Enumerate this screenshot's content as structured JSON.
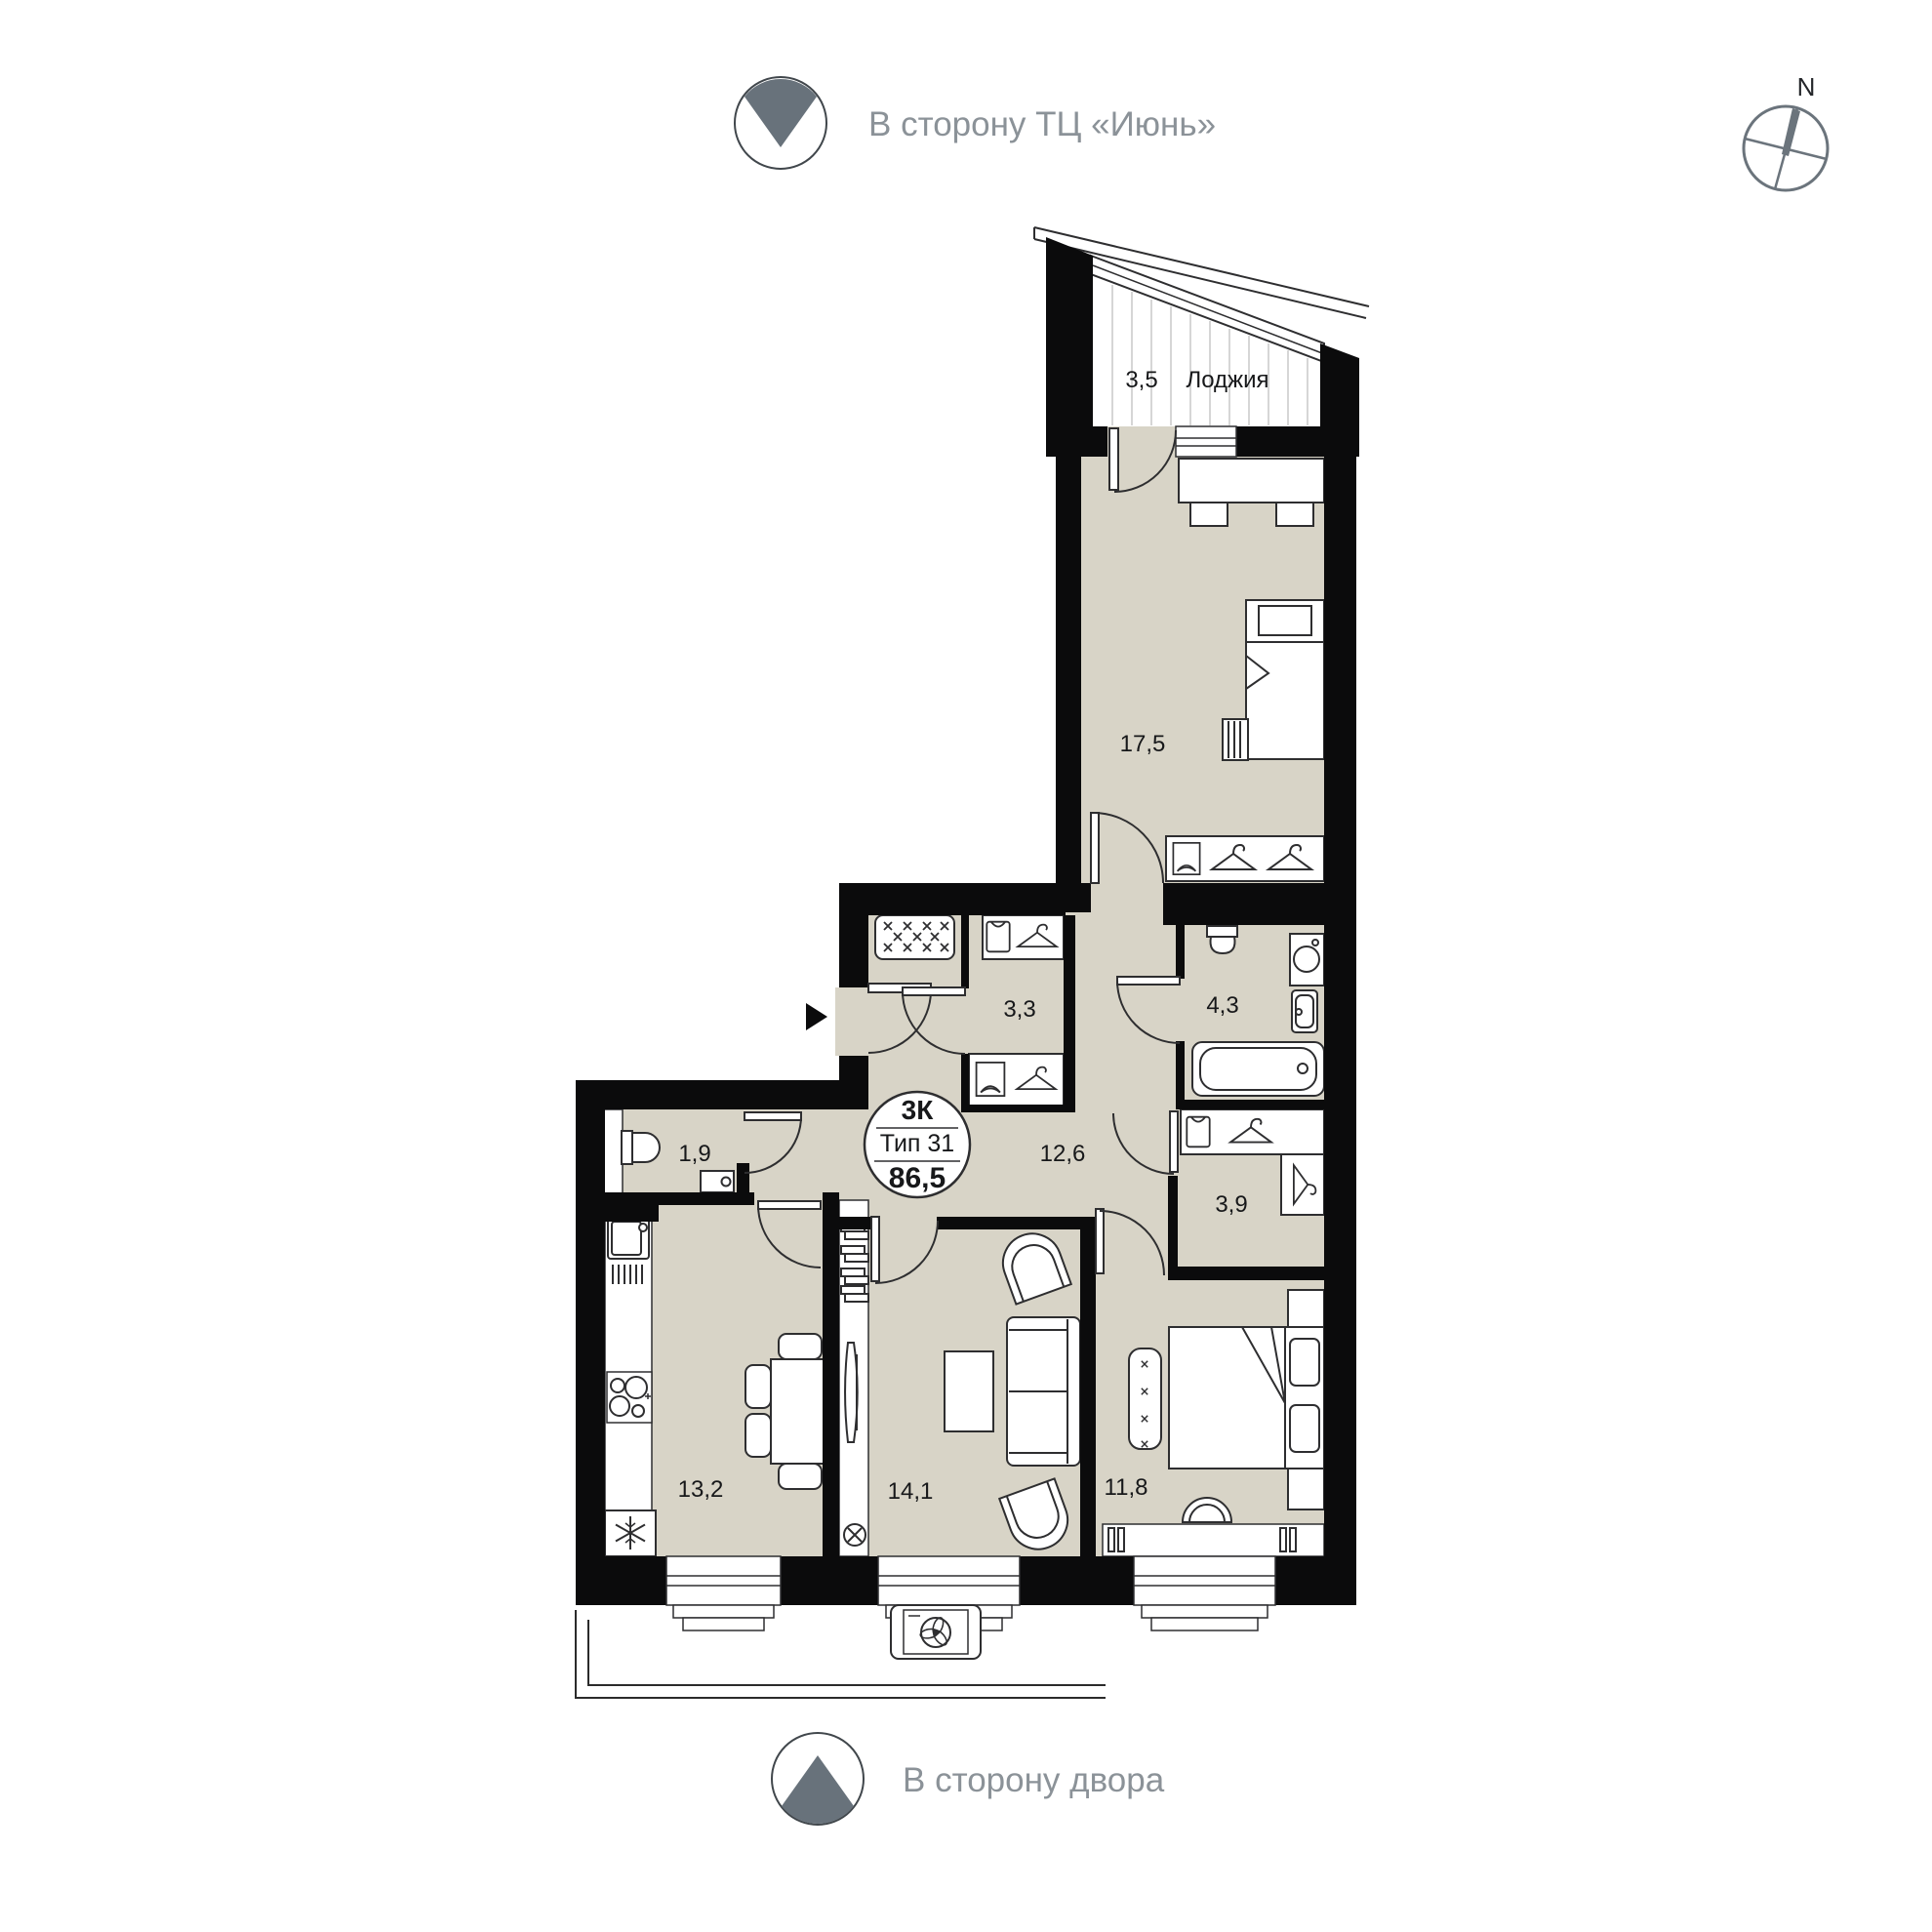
{
  "direction_top": {
    "label": "В сторону ТЦ «Июнь»"
  },
  "direction_bottom": {
    "label": "В сторону двора"
  },
  "compass": {
    "north": "N"
  },
  "badge": {
    "rooms": "3К",
    "type": "Тип 31",
    "area": "86,5"
  },
  "rooms": {
    "loggia": {
      "area": "3,5",
      "name": "Лоджия"
    },
    "bedroom_main": {
      "area": "17,5"
    },
    "wardrobe_entry": {
      "area": "3,3"
    },
    "bathroom": {
      "area": "4,3"
    },
    "hallway": {
      "area": "12,6"
    },
    "wc": {
      "area": "1,9"
    },
    "wardrobe_bedroom": {
      "area": "3,9"
    },
    "kitchen": {
      "area": "13,2"
    },
    "living": {
      "area": "14,1"
    },
    "bedroom_second": {
      "area": "11,8"
    }
  },
  "colors": {
    "wall": "#0b0b0c",
    "floor": "#d8d4c7",
    "accent_gray": "#68727b",
    "label": "#17181a",
    "muted": "#8b9298",
    "stroke": "#2e2e30"
  }
}
